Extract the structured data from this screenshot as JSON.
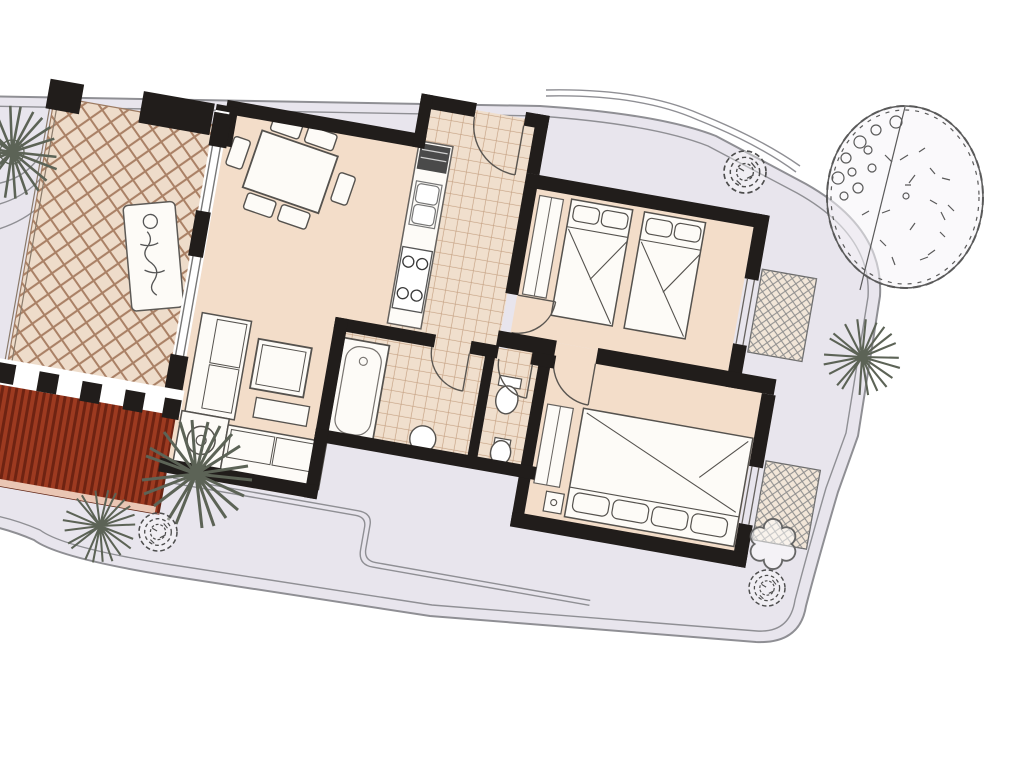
{
  "scene": {
    "title": "Two-bedroom apartment floor plan with terrace and garden",
    "type": "architectural-floor-plan",
    "rotation_deg": 10,
    "colors": {
      "paper": "#ffffff",
      "plot": "#e8e5ed",
      "plot_line": "#8f8f94",
      "room": "#f3ddc9",
      "terrace": "#eedcca",
      "lattice": "#aa8166",
      "tile": "#f0dfcd",
      "tile_line": "#c5a183",
      "wall": "#211d1b",
      "pergola": "#9d3a20",
      "pergola_stripe": "#6e2312",
      "pergola_edge": "#eac6b4",
      "outline": "#4f4c49",
      "furniture_fill": "#fdfbf7",
      "plant": "#5c6356",
      "scribble": "#4d4d4d",
      "tree": "#5a5a5a",
      "tree_fill": "#f6f4f8"
    },
    "rooms": [
      {
        "name": "terrace",
        "floor": "diagonal-lattice-tiles"
      },
      {
        "name": "living-dining-room",
        "floor": "plain"
      },
      {
        "name": "kitchen",
        "floor": "square-tiles"
      },
      {
        "name": "hallway",
        "floor": "square-tiles"
      },
      {
        "name": "bathroom",
        "floor": "square-tiles"
      },
      {
        "name": "wc",
        "floor": "square-tiles"
      },
      {
        "name": "bedroom-1",
        "floor": "plain"
      },
      {
        "name": "bedroom-2",
        "floor": "plain"
      },
      {
        "name": "pergola",
        "floor": "red-slats"
      }
    ],
    "furniture": {
      "dining_table_seats": 6,
      "sofas": 2,
      "coffee_tables": 1,
      "side_unit_with_lamp": 1,
      "sun_loungers": 1,
      "kitchen": [
        "fridge",
        "double-sink",
        "four-burner-stove",
        "counter"
      ],
      "bathroom": [
        "bathtub",
        "washbasin"
      ],
      "wc": [
        "toilet",
        "bidet"
      ],
      "beds": {
        "twin": 2,
        "double": 1
      },
      "wardrobes": 3,
      "nightstands": 1,
      "window_flower_boxes": 2
    },
    "garden": {
      "large_tree": 1,
      "round_shrubs": 3,
      "spiky_palms": 4,
      "paths": "double-line walkways with rounded plot boundary"
    }
  }
}
